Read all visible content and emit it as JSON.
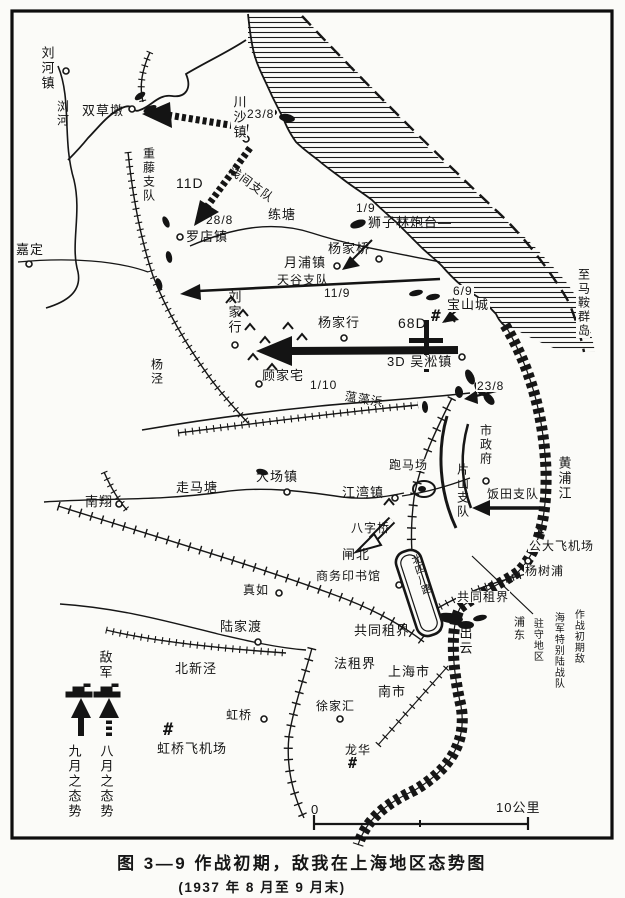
{
  "caption": {
    "line1": "图 3—9  作战初期，敌我在上海地区态势图",
    "line2": "(1937 年 8 月至 9 月末)"
  },
  "colors": {
    "ink": "#161616",
    "paper": "#fbfbf8"
  },
  "labels": [
    {
      "name": "label-liuhezhen",
      "text": "刘河镇",
      "x": 40,
      "y": 46,
      "v": true,
      "fs": 13
    },
    {
      "name": "label-liuhe-river",
      "text": "浏河",
      "x": 56,
      "y": 100,
      "v": true,
      "fs": 12
    },
    {
      "name": "label-shuangcaodun",
      "text": "双草墩",
      "x": 82,
      "y": 104,
      "fs": 13
    },
    {
      "name": "label-chuanshazhen",
      "text": "川沙镇",
      "x": 231,
      "y": 95,
      "v": true,
      "fs": 13,
      "bg": true
    },
    {
      "name": "date-chuansha",
      "text": "23/8",
      "x": 246,
      "y": 108,
      "fs": 12,
      "bg": true
    },
    {
      "name": "label-shigefuji-detachment",
      "text": "重藤支队",
      "x": 142,
      "y": 147,
      "v": true,
      "fs": 12
    },
    {
      "name": "label-11d",
      "text": "11D",
      "x": 176,
      "y": 176,
      "fs": 14
    },
    {
      "name": "label-asama-detachment",
      "text": "浅间支队",
      "x": 234,
      "y": 164,
      "fs": 12,
      "rot": 36
    },
    {
      "name": "label-liantang",
      "text": "练塘",
      "x": 268,
      "y": 208,
      "fs": 13
    },
    {
      "name": "date-luodian",
      "text": "28/8",
      "x": 206,
      "y": 214,
      "fs": 12
    },
    {
      "name": "label-luodianzhen",
      "text": "罗店镇",
      "x": 186,
      "y": 230,
      "fs": 13
    },
    {
      "name": "label-jiading",
      "text": "嘉定",
      "x": 16,
      "y": 243,
      "fs": 13
    },
    {
      "name": "date-shizilin",
      "text": "1/9",
      "x": 356,
      "y": 202,
      "fs": 12
    },
    {
      "name": "label-shizilin-fort",
      "text": "狮子林炮台—",
      "x": 368,
      "y": 216,
      "fs": 13
    },
    {
      "name": "label-yangjiaqiao",
      "text": "杨家桥",
      "x": 328,
      "y": 242,
      "fs": 13
    },
    {
      "name": "label-yuepuzhen",
      "text": "月浦镇",
      "x": 284,
      "y": 256,
      "fs": 13
    },
    {
      "name": "label-tiangu-detachment",
      "text": "天谷支队",
      "x": 277,
      "y": 274,
      "fs": 12
    },
    {
      "name": "date-tiangu",
      "text": "11/9",
      "x": 324,
      "y": 287,
      "fs": 12
    },
    {
      "name": "label-liujiahang",
      "text": "刘家行",
      "x": 227,
      "y": 290,
      "v": true,
      "fs": 13
    },
    {
      "name": "label-yangjing",
      "text": "杨泾",
      "x": 150,
      "y": 358,
      "v": true,
      "fs": 12
    },
    {
      "name": "label-yangjiahang",
      "text": "杨家行",
      "x": 318,
      "y": 316,
      "fs": 13
    },
    {
      "name": "label-68d",
      "text": "68D",
      "x": 398,
      "y": 316,
      "fs": 14
    },
    {
      "name": "fort-symbol-baoshan",
      "text": "#",
      "x": 431,
      "y": 308,
      "fs": 16,
      "sym": true
    },
    {
      "name": "date-baoshan",
      "text": "6/9",
      "x": 452,
      "y": 285,
      "fs": 12,
      "bg": true
    },
    {
      "name": "label-baoshancheng",
      "text": "宝山城",
      "x": 446,
      "y": 298,
      "fs": 13,
      "bg": true
    },
    {
      "name": "label-zhi-maan-islands",
      "text": "至马鞍群岛",
      "x": 576,
      "y": 268,
      "v": true,
      "fs": 12,
      "bg": true
    },
    {
      "name": "label-3d-wusongzhen",
      "text": "3D 吴淞镇",
      "x": 386,
      "y": 355,
      "fs": 13,
      "bg": true
    },
    {
      "name": "date-wusong",
      "text": "23/8",
      "x": 476,
      "y": 380,
      "fs": 12,
      "bg": true
    },
    {
      "name": "label-gujiazhai",
      "text": "顾家宅",
      "x": 262,
      "y": 369,
      "fs": 13
    },
    {
      "name": "date-gujiazhai",
      "text": "1/10",
      "x": 310,
      "y": 379,
      "fs": 12
    },
    {
      "name": "label-wenzaobang",
      "text": "蕰藻浜",
      "x": 346,
      "y": 390,
      "fs": 12,
      "rot": 10
    },
    {
      "name": "label-zoumatang",
      "text": "走马塘",
      "x": 176,
      "y": 481,
      "fs": 13
    },
    {
      "name": "label-nanxiang",
      "text": "南翔",
      "x": 85,
      "y": 495,
      "fs": 13
    },
    {
      "name": "label-dachangzhen",
      "text": "大场镇",
      "x": 256,
      "y": 470,
      "fs": 13
    },
    {
      "name": "label-jiangwanzhen",
      "text": "江湾镇",
      "x": 342,
      "y": 486,
      "fs": 13
    },
    {
      "name": "label-paomachang",
      "text": "跑马场",
      "x": 388,
      "y": 459,
      "fs": 12,
      "bg": true
    },
    {
      "name": "label-pianshan-detachment",
      "text": "片山支队",
      "x": 456,
      "y": 463,
      "v": true,
      "fs": 12
    },
    {
      "name": "label-shizhengfu",
      "text": "市政府",
      "x": 479,
      "y": 424,
      "v": true,
      "fs": 12
    },
    {
      "name": "label-iida-detachment",
      "text": "饭田支队",
      "x": 486,
      "y": 488,
      "fs": 12,
      "bg": true
    },
    {
      "name": "label-huangpujiang",
      "text": "黄浦江",
      "x": 557,
      "y": 456,
      "v": true,
      "fs": 13
    },
    {
      "name": "fort-symbol-gongda",
      "text": "#",
      "x": 536,
      "y": 525,
      "fs": 14,
      "sym": true
    },
    {
      "name": "label-gongda-airfield",
      "text": "公大飞机场",
      "x": 528,
      "y": 540,
      "fs": 12,
      "bg": true
    },
    {
      "name": "label-yangshupu",
      "text": "杨树浦",
      "x": 524,
      "y": 565,
      "fs": 12,
      "bg": true
    },
    {
      "name": "label-baziqiao",
      "text": "八字桥",
      "x": 351,
      "y": 522,
      "fs": 12
    },
    {
      "name": "label-zhabei",
      "text": "闸北",
      "x": 342,
      "y": 548,
      "fs": 13
    },
    {
      "name": "label-shangwu-press",
      "text": "商务印书馆",
      "x": 316,
      "y": 570,
      "fs": 12
    },
    {
      "name": "label-beisichuan-road",
      "text": "北四川路",
      "x": 409,
      "y": 556,
      "v": true,
      "fs": 10.5,
      "rot": -18,
      "ls": 0
    },
    {
      "name": "label-international-settlement-east",
      "text": "共同租界",
      "x": 456,
      "y": 591,
      "fs": 12,
      "bg": true
    },
    {
      "name": "label-pudong",
      "text": "浦东",
      "x": 512,
      "y": 616,
      "v": true,
      "fs": 11
    },
    {
      "name": "annotation-col-1",
      "text": "作战初期敌",
      "x": 572,
      "y": 609,
      "v": true,
      "fs": 10,
      "ls": 1
    },
    {
      "name": "annotation-col-2",
      "text": "海军特别陆战队",
      "x": 552,
      "y": 612,
      "v": true,
      "fs": 10,
      "ls": 1
    },
    {
      "name": "annotation-col-3",
      "text": "驻守地区",
      "x": 531,
      "y": 618,
      "v": true,
      "fs": 10,
      "ls": 1
    },
    {
      "name": "label-international-settlement-west",
      "text": "共同租界",
      "x": 354,
      "y": 624,
      "fs": 13
    },
    {
      "name": "label-izumo",
      "text": "出云",
      "x": 458,
      "y": 626,
      "v": true,
      "fs": 13
    },
    {
      "name": "label-zhenru",
      "text": "真如",
      "x": 243,
      "y": 584,
      "fs": 12
    },
    {
      "name": "label-lujiadu",
      "text": "陆家渡",
      "x": 220,
      "y": 620,
      "fs": 13
    },
    {
      "name": "label-beixinjing",
      "text": "北新泾",
      "x": 175,
      "y": 662,
      "fs": 13
    },
    {
      "name": "legend-enemy",
      "text": "敌军",
      "x": 98,
      "y": 650,
      "v": true,
      "fs": 13
    },
    {
      "name": "legend-september",
      "text": "九月之态势",
      "x": 67,
      "y": 744,
      "v": true,
      "fs": 13
    },
    {
      "name": "legend-august",
      "text": "八月之态势",
      "x": 99,
      "y": 744,
      "v": true,
      "fs": 13
    },
    {
      "name": "label-french-concession",
      "text": "法租界",
      "x": 334,
      "y": 657,
      "fs": 13
    },
    {
      "name": "label-shanghai-city",
      "text": "上海市",
      "x": 388,
      "y": 665,
      "fs": 13
    },
    {
      "name": "label-nanshi",
      "text": "南市",
      "x": 378,
      "y": 685,
      "fs": 13
    },
    {
      "name": "label-xujiahui",
      "text": "徐家汇",
      "x": 316,
      "y": 700,
      "fs": 12
    },
    {
      "name": "label-hongqiao",
      "text": "虹桥",
      "x": 226,
      "y": 709,
      "fs": 12
    },
    {
      "name": "fort-symbol-hongqiao",
      "text": "#",
      "x": 163,
      "y": 722,
      "fs": 17,
      "sym": true
    },
    {
      "name": "label-hongqiao-airfield",
      "text": "虹桥飞机场",
      "x": 157,
      "y": 742,
      "fs": 13
    },
    {
      "name": "label-longhua",
      "text": "龙华",
      "x": 345,
      "y": 744,
      "fs": 12
    },
    {
      "name": "fort-symbol-longhua",
      "text": "#",
      "x": 348,
      "y": 756,
      "fs": 15,
      "sym": true
    },
    {
      "name": "scale-zero",
      "text": "0",
      "x": 311,
      "y": 803,
      "fs": 13
    },
    {
      "name": "scale-ten-km",
      "text": "10公里",
      "x": 496,
      "y": 801,
      "fs": 13
    }
  ]
}
